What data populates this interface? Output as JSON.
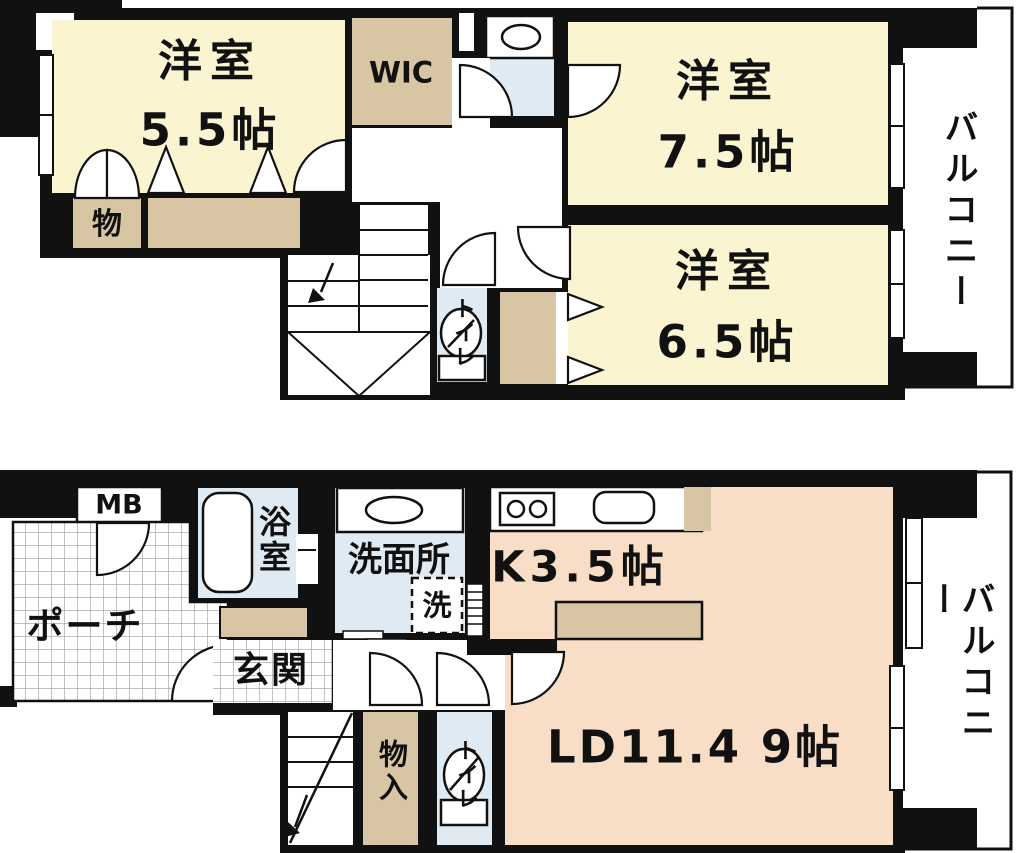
{
  "title": "2-story apartment floor plan (maisonette)",
  "colors": {
    "wall": "#111111",
    "room_yellow": "#FAF4D1",
    "closet_tan": "#D8C5A3",
    "room_peach": "#F8DEC6",
    "wet_blue": "#DFEAF2",
    "tile_line": "#9a9a9a"
  },
  "floor2": {
    "room55": {
      "label": "洋室",
      "size": "5.5帖"
    },
    "room75": {
      "label": "洋室",
      "size": "7.5帖"
    },
    "room65": {
      "label": "洋室",
      "size": "6.5帖"
    },
    "wic": "WIC",
    "storage": "物",
    "toilet": "トイレ",
    "balcony": "バルコニー"
  },
  "floor1": {
    "meter_box": "MB",
    "porch": "ポーチ",
    "bath": "浴室",
    "washroom": "洗面所",
    "washer": "洗",
    "kitchen": "K3.5帖",
    "entrance": "玄関",
    "closet": "物入",
    "toilet": "トイレ",
    "living_dining": "LD11.4 9帖",
    "balcony": "バルコニー"
  }
}
